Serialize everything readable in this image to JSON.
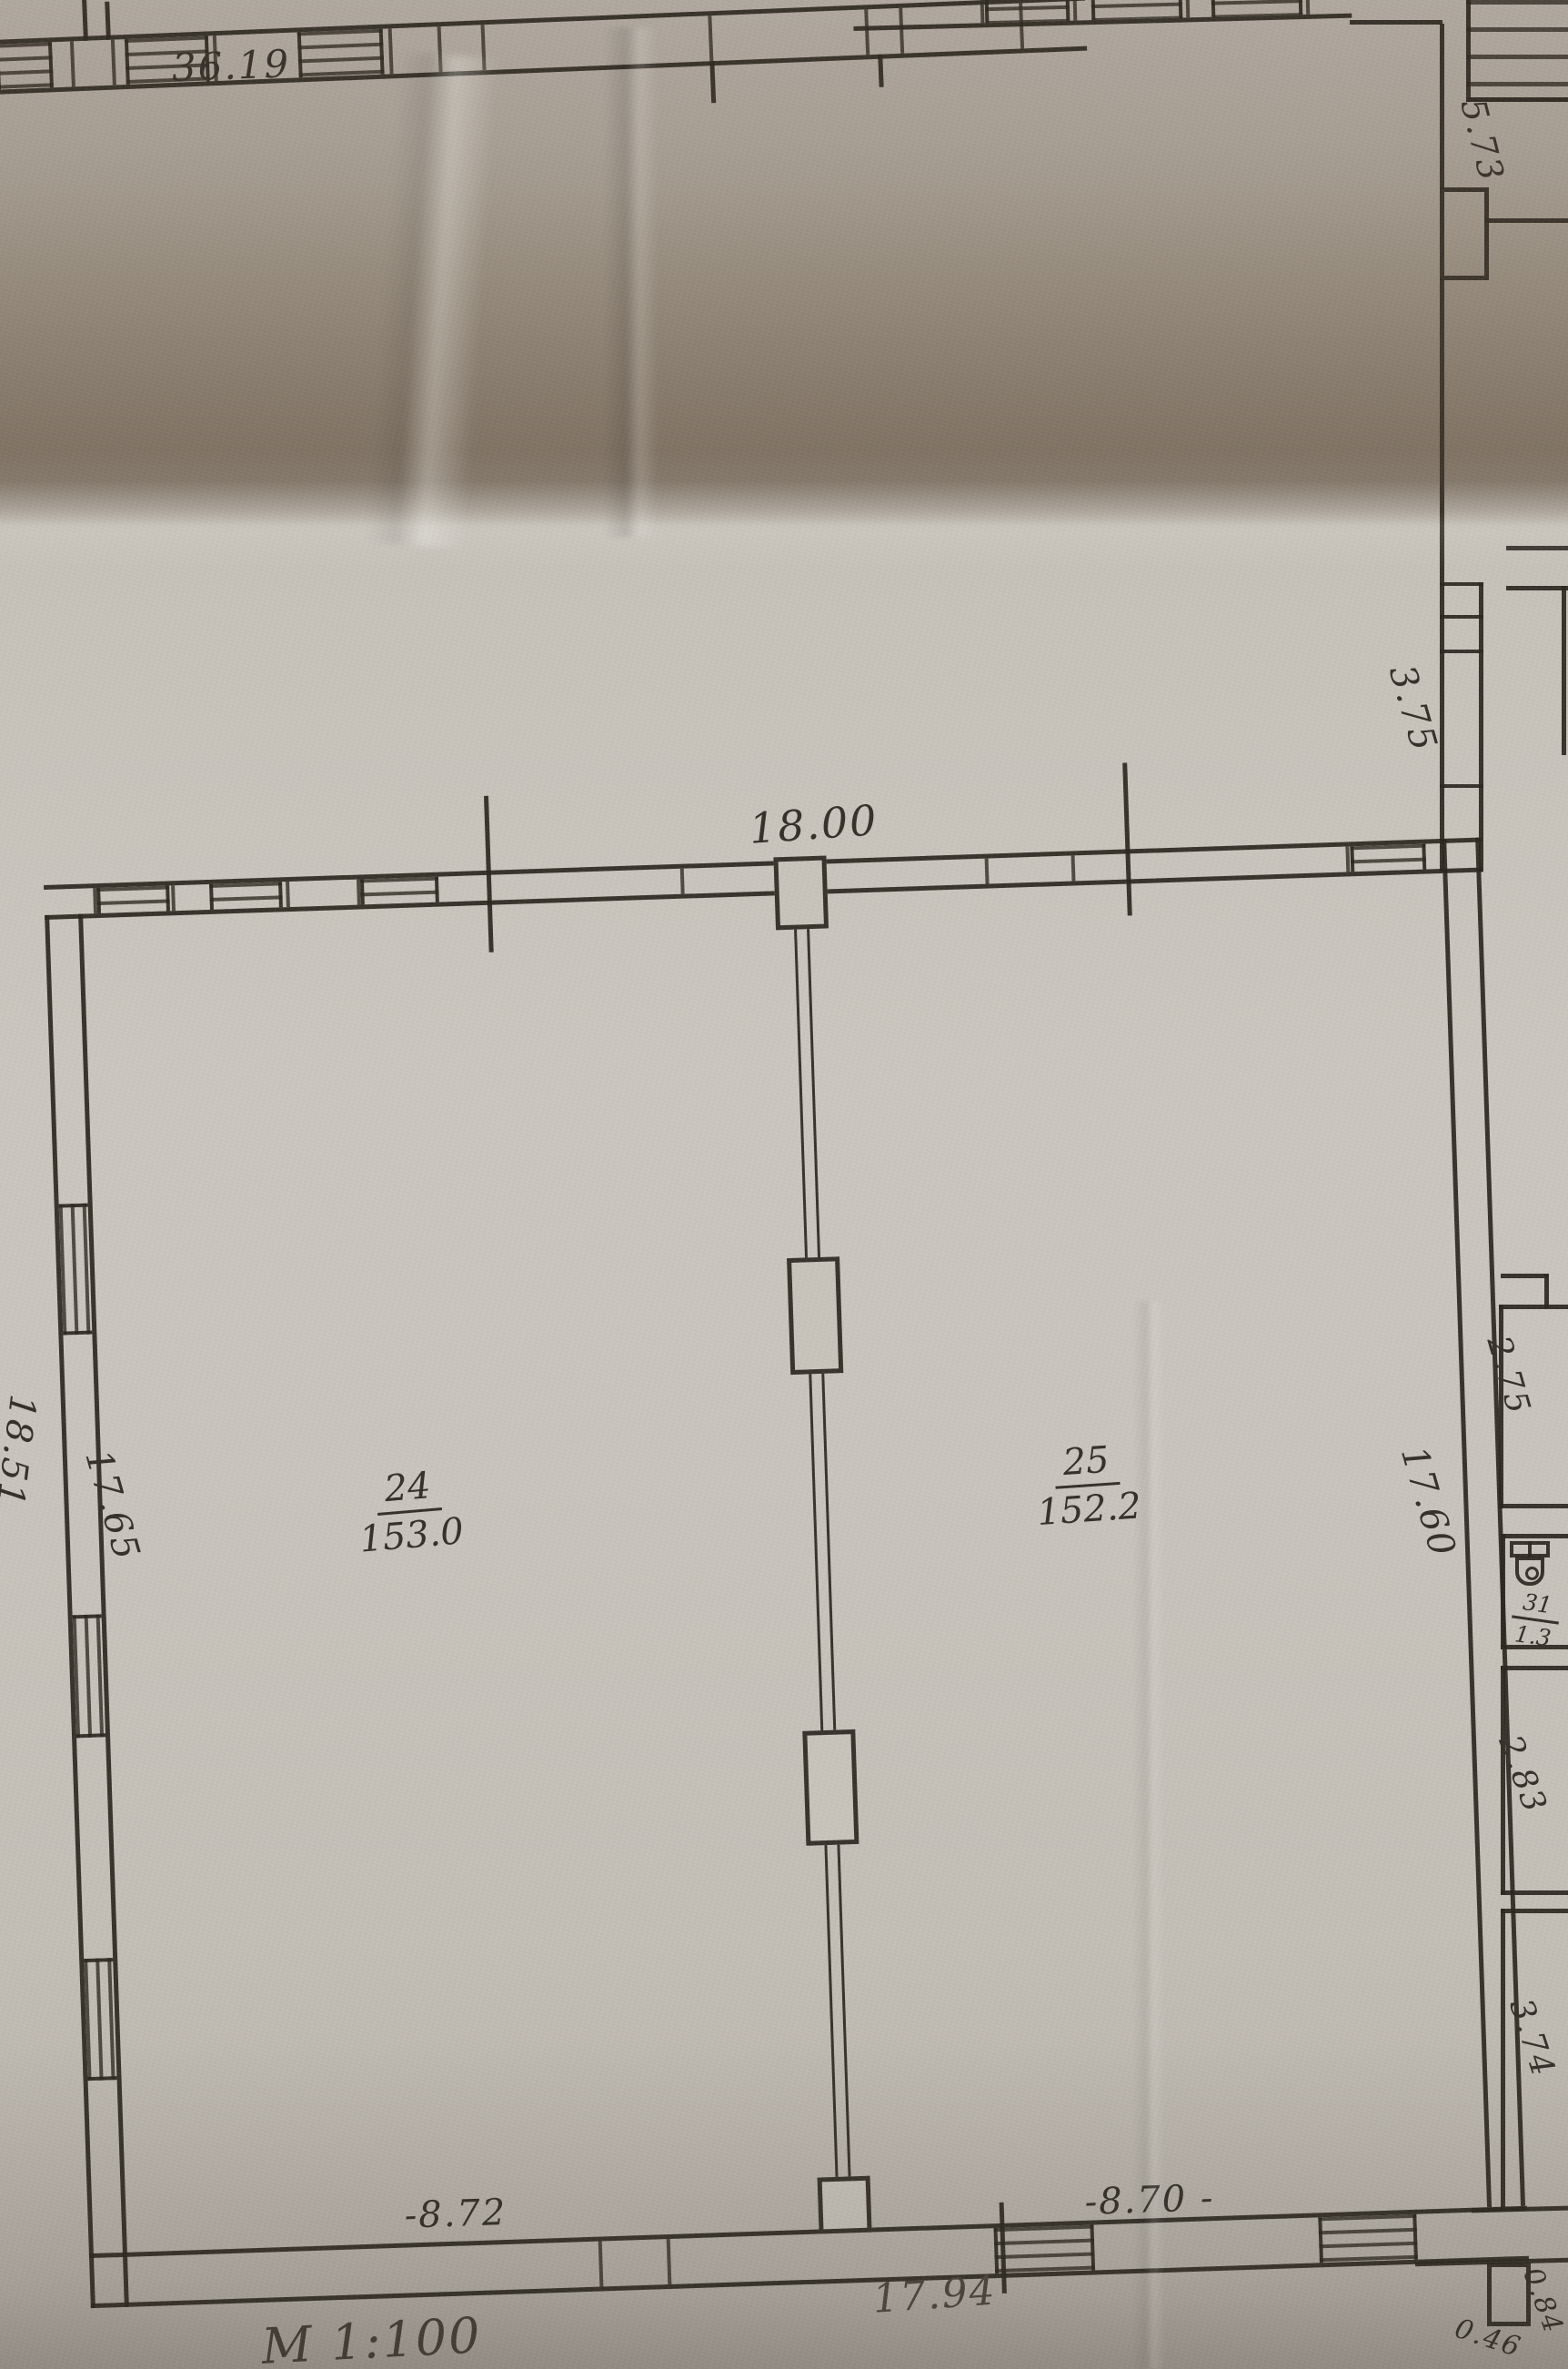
{
  "plan": {
    "scale": "М 1:100",
    "rooms": {
      "room24": {
        "number": "24",
        "area": "153.0"
      },
      "room25": {
        "number": "25",
        "area": "152.2"
      },
      "wc": {
        "number": "31",
        "area": "1.3"
      }
    },
    "dims": {
      "d3619": "36.19",
      "d573": "5.73",
      "d375": "3.75",
      "d1800": "18.00",
      "d1851": "18.51",
      "d1765": "17.65",
      "d1760": "17.60",
      "d275": "2.75",
      "d283": "2.83",
      "d374": "3.74",
      "e872": "-8.72",
      "e870": "-8.70 -",
      "d1794": "17.94",
      "d084": "0.84",
      "d046": "0.46"
    },
    "colors": {
      "ink": "#2b2720",
      "paper": "#c9c4bd",
      "shadow": "#55463a"
    }
  }
}
